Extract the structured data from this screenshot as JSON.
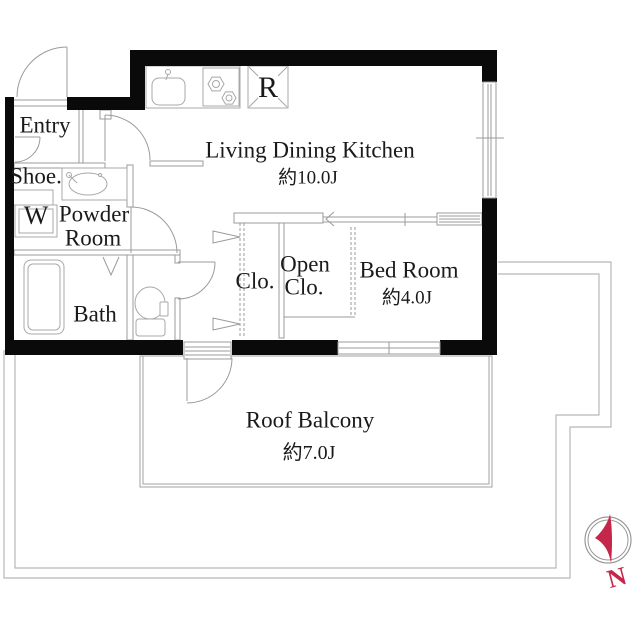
{
  "floorplan": {
    "rooms": [
      {
        "label": "Entry",
        "size": ""
      },
      {
        "label": "Shoe.",
        "size": ""
      },
      {
        "label": "W",
        "size": ""
      },
      {
        "label": "Powder Room",
        "size": ""
      },
      {
        "label": "Bath",
        "size": ""
      },
      {
        "label": "Living Dining Kitchen",
        "size": "約10.0J"
      },
      {
        "label": "Clo.",
        "size": ""
      },
      {
        "label": "Open Clo.",
        "size": ""
      },
      {
        "label": "Bed Room",
        "size": "約4.0J"
      },
      {
        "label": "Roof Balcony",
        "size": "約7.0J"
      }
    ],
    "labels": {
      "entry": "Entry",
      "shoe": "Shoe.",
      "washer": "W",
      "powder_line1": "Powder",
      "powder_line2": "Room",
      "bath": "Bath",
      "ldk": "Living Dining Kitchen",
      "ldk_size": "約10.0J",
      "closet": "Clo.",
      "open_closet_line1": "Open",
      "open_closet_line2": "Clo.",
      "bedroom": "Bed Room",
      "bedroom_size": "約4.0J",
      "balcony": "Roof Balcony",
      "balcony_size": "約7.0J"
    },
    "fixtures": {
      "refrigerator_label": "R"
    },
    "compass": {
      "north_label": "N",
      "needle_color": "#c4274a",
      "ring_color": "#999999"
    },
    "colors": {
      "wall": "#0a0a0a",
      "line": "#9b9b9b",
      "boundary": "#b8b8b8",
      "background": "#ffffff",
      "text": "#1a1a1a"
    }
  }
}
